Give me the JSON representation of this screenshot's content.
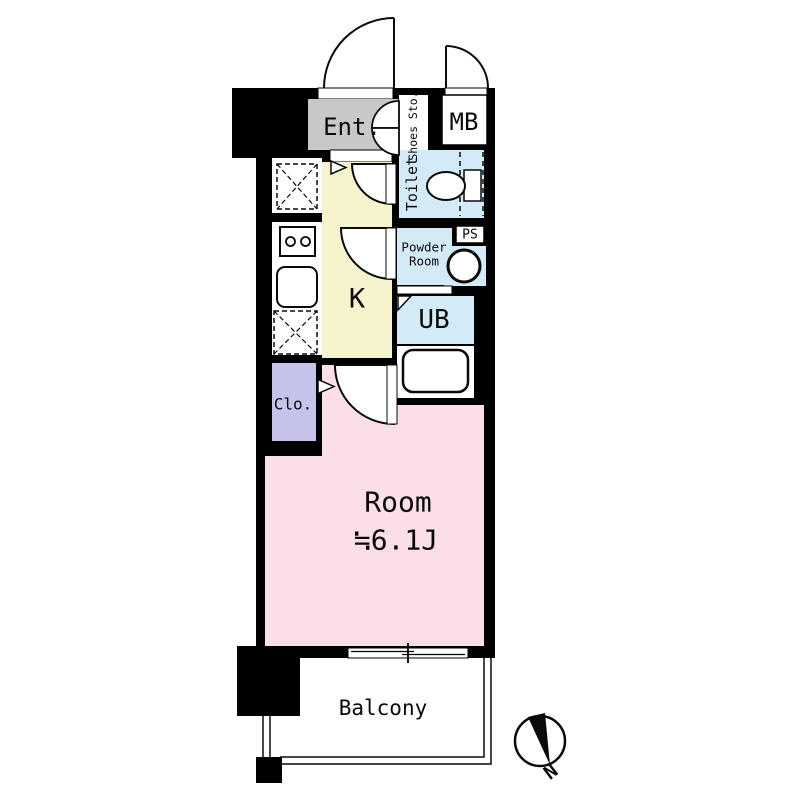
{
  "plan": {
    "labels": {
      "entrance": "Ent.",
      "shoe_storage": "Shoes Sto.",
      "meter_box": "MB",
      "toilet": "Toilet",
      "powder_room_line1": "Powder",
      "powder_room_line2": "Room",
      "pipe_space": "PS",
      "kitchen": "K",
      "unit_bath": "UB",
      "closet": "Clo.",
      "room": "Room",
      "room_size": "≒6.1J",
      "balcony": "Balcony",
      "compass_north": "N"
    },
    "colors": {
      "wall": "#000000",
      "entrance": "#c8c8c8",
      "kitchen": "#f7f3cd",
      "wet_area": "#d3eaf7",
      "closet": "#c5c3ea",
      "room": "#fbdfe8",
      "floor_white": "#ffffff"
    }
  }
}
